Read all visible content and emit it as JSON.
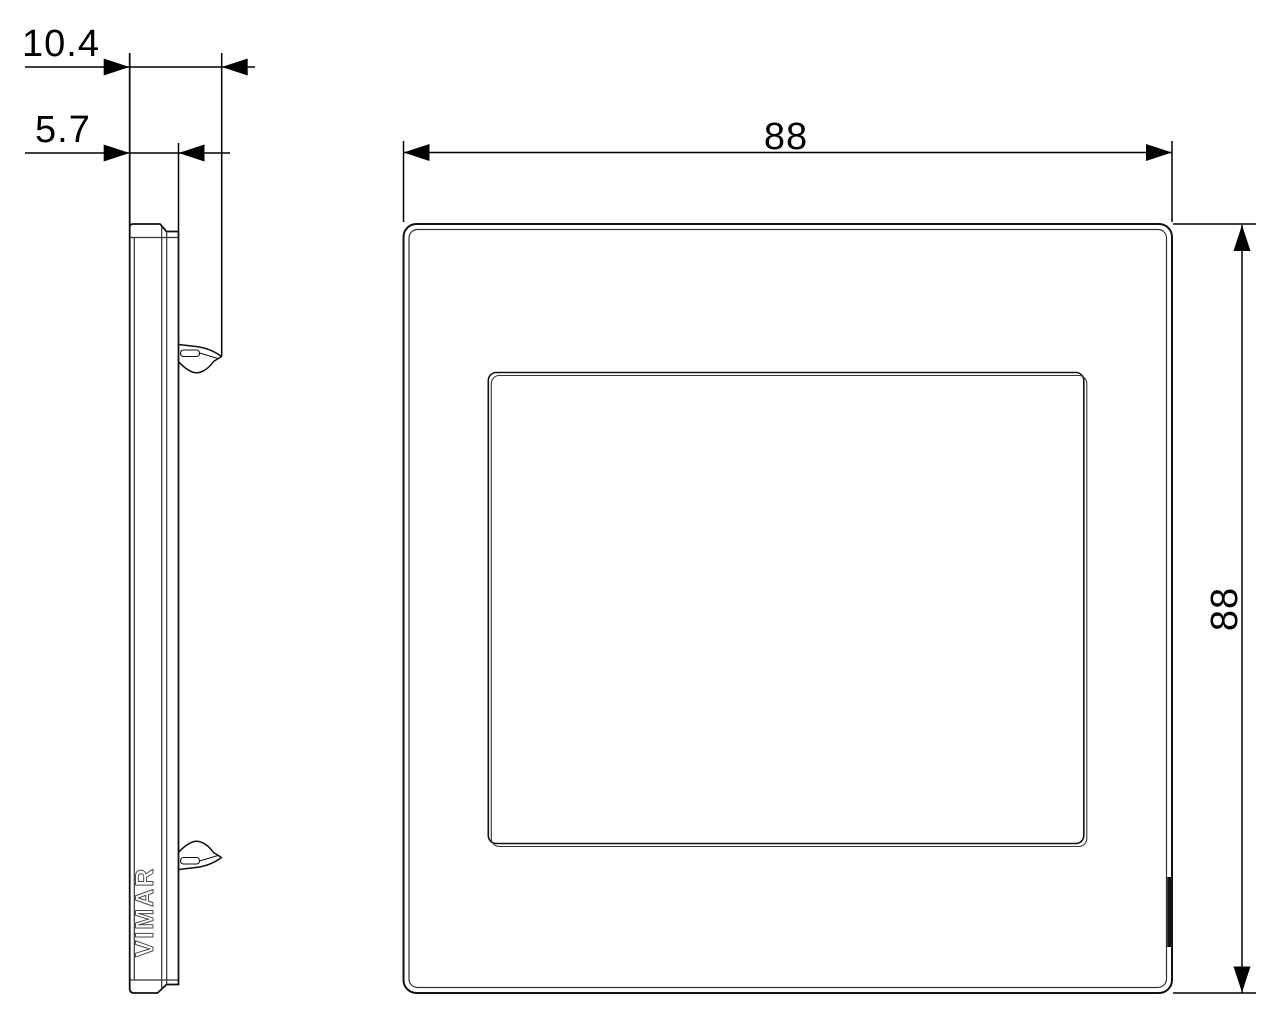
{
  "brand": {
    "logo_text": "VIMAR"
  },
  "dimensions": {
    "depth_total_mm": "10.4",
    "depth_plate_mm": "5.7",
    "width_mm": "88",
    "height_mm": "88"
  }
}
